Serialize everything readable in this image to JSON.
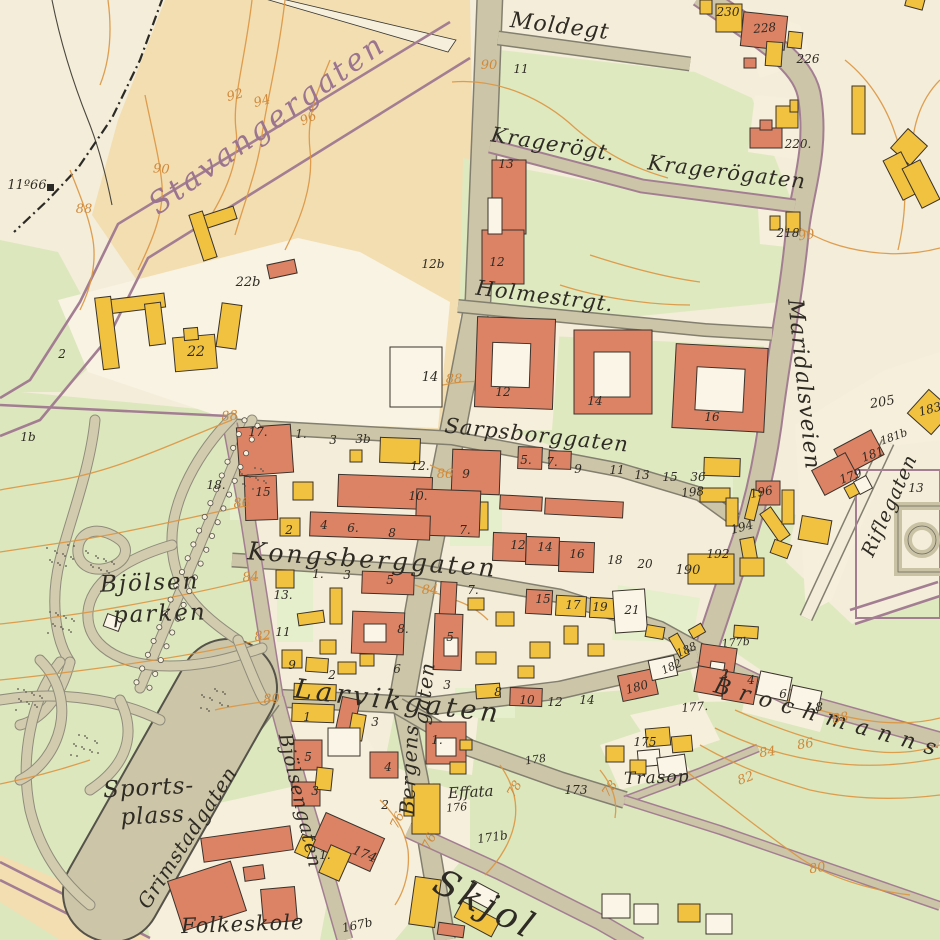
{
  "map": {
    "type": "historical-city-district-map",
    "district": "Bjölsen",
    "palette": {
      "background": "#f4edd9",
      "field_tan": "#f3deb2",
      "green": "#dfe9c0",
      "park_green": "#dce7bd",
      "road": "#ccc5a7",
      "building_red": "#dc8265",
      "building_yellow": "#f1c23f",
      "purple_line": "#a37e93",
      "contour_orange": "#db9540",
      "label_black": "#2e2b24",
      "script_purple": "#9b7490"
    },
    "street_labels": [
      {
        "t": "Stavangergaten",
        "x": 273,
        "y": 132,
        "r": -36,
        "s": 30,
        "ls": 3,
        "c": "purple"
      },
      {
        "t": "Moldegt",
        "x": 559,
        "y": 33,
        "r": 7,
        "s": 22,
        "ls": 1
      },
      {
        "t": "Kragerögt.",
        "x": 552,
        "y": 151,
        "r": 9,
        "s": 21,
        "ls": 1
      },
      {
        "t": "Kragerögaten",
        "x": 726,
        "y": 179,
        "r": 7,
        "s": 21,
        "ls": 1
      },
      {
        "t": "Holmestrgt.",
        "x": 544,
        "y": 303,
        "r": 7,
        "s": 21,
        "ls": 1
      },
      {
        "t": "Sarpsborggaten",
        "x": 536,
        "y": 442,
        "r": 6,
        "s": 21,
        "ls": 1
      },
      {
        "t": "Maridalsveien",
        "x": 797,
        "y": 385,
        "r": 84,
        "s": 22,
        "ls": 1
      },
      {
        "t": "Kongsberggaten",
        "x": 372,
        "y": 568,
        "r": 4,
        "s": 25,
        "ls": 3
      },
      {
        "t": "Larvikgaten",
        "x": 397,
        "y": 710,
        "r": 7,
        "s": 27,
        "ls": 4
      },
      {
        "t": "Bergens",
        "x": 416,
        "y": 770,
        "r": -87,
        "s": 20,
        "ls": 1
      },
      {
        "t": "gaten",
        "x": 431,
        "y": 694,
        "r": -83,
        "s": 20,
        "ls": 1
      },
      {
        "t": "Bjölsengaten",
        "x": 294,
        "y": 802,
        "r": 77,
        "s": 19,
        "ls": 1
      },
      {
        "t": "Grimstadgaten",
        "x": 193,
        "y": 841,
        "r": -57,
        "s": 20,
        "ls": 1
      },
      {
        "t": "Riflegaten",
        "x": 895,
        "y": 508,
        "r": -66,
        "s": 19,
        "ls": 1
      },
      {
        "t": "Brochmanns",
        "x": 828,
        "y": 725,
        "r": 16,
        "s": 22,
        "ls": 10
      },
      {
        "t": "Skjol",
        "x": 480,
        "y": 915,
        "r": 27,
        "s": 36,
        "ls": 4
      }
    ],
    "place_labels": [
      {
        "t": "Bjölsen",
        "x": 150,
        "y": 590,
        "r": -2,
        "s": 23,
        "ls": 2
      },
      {
        "t": "parken",
        "x": 160,
        "y": 621,
        "r": -2,
        "s": 23,
        "ls": 2
      },
      {
        "t": "Sports-",
        "x": 149,
        "y": 795,
        "r": -3,
        "s": 23,
        "ls": 1
      },
      {
        "t": "plass",
        "x": 153,
        "y": 823,
        "r": -3,
        "s": 23,
        "ls": 1
      },
      {
        "t": "Folkeskole",
        "x": 243,
        "y": 931,
        "r": -2,
        "s": 21,
        "ls": 1
      },
      {
        "t": "Trasop",
        "x": 657,
        "y": 783,
        "r": -2,
        "s": 17,
        "ls": 1
      },
      {
        "t": "Effata",
        "x": 471,
        "y": 797,
        "r": -3,
        "s": 15,
        "ls": 0
      }
    ],
    "contour_labels": [
      {
        "t": "92",
        "x": 236,
        "y": 99,
        "r": -15
      },
      {
        "t": "94",
        "x": 263,
        "y": 105,
        "r": -15
      },
      {
        "t": "96",
        "x": 310,
        "y": 122,
        "r": -25
      },
      {
        "t": "90",
        "x": 161,
        "y": 173,
        "r": 5
      },
      {
        "t": "88",
        "x": 84,
        "y": 213,
        "r": 0
      },
      {
        "t": "90",
        "x": 489,
        "y": 69,
        "r": 0
      },
      {
        "t": "90",
        "x": 807,
        "y": 239,
        "r": -10
      },
      {
        "t": "88",
        "x": 454,
        "y": 383,
        "r": 0
      },
      {
        "t": "88",
        "x": 230,
        "y": 420,
        "r": -5
      },
      {
        "t": "86",
        "x": 242,
        "y": 507,
        "r": -5
      },
      {
        "t": "86",
        "x": 445,
        "y": 478,
        "r": 0
      },
      {
        "t": "84",
        "x": 251,
        "y": 581,
        "r": -5
      },
      {
        "t": "84",
        "x": 430,
        "y": 594,
        "r": 0
      },
      {
        "t": "82",
        "x": 263,
        "y": 640,
        "r": -5
      },
      {
        "t": "80",
        "x": 272,
        "y": 703,
        "r": -5
      },
      {
        "t": "76",
        "x": 401,
        "y": 822,
        "r": -65
      },
      {
        "t": "76",
        "x": 433,
        "y": 843,
        "r": -65
      },
      {
        "t": "78",
        "x": 518,
        "y": 791,
        "r": -60
      },
      {
        "t": "78",
        "x": 613,
        "y": 791,
        "r": -55
      },
      {
        "t": "88",
        "x": 841,
        "y": 722,
        "r": -10
      },
      {
        "t": "86",
        "x": 806,
        "y": 748,
        "r": -10
      },
      {
        "t": "84",
        "x": 768,
        "y": 756,
        "r": -8
      },
      {
        "t": "82",
        "x": 747,
        "y": 782,
        "r": -20
      },
      {
        "t": "80",
        "x": 818,
        "y": 872,
        "r": -10
      }
    ],
    "parcel_labels": [
      {
        "t": "11º66",
        "x": 27,
        "y": 189,
        "s": 13
      },
      {
        "t": "2",
        "x": 62,
        "y": 358
      },
      {
        "t": "22b",
        "x": 248,
        "y": 286,
        "s": 13
      },
      {
        "t": "22",
        "x": 196,
        "y": 356,
        "s": 14
      },
      {
        "t": "12b",
        "x": 433,
        "y": 268
      },
      {
        "t": "14",
        "x": 430,
        "y": 381,
        "s": 13
      },
      {
        "t": "1b",
        "x": 28,
        "y": 441
      },
      {
        "t": "18.",
        "x": 216,
        "y": 489
      },
      {
        "t": "13.",
        "x": 283,
        "y": 599
      },
      {
        "t": "11",
        "x": 521,
        "y": 73
      },
      {
        "t": "13",
        "x": 506,
        "y": 168
      },
      {
        "t": "12",
        "x": 497,
        "y": 266
      },
      {
        "t": "12",
        "x": 503,
        "y": 396
      },
      {
        "t": "14",
        "x": 595,
        "y": 405
      },
      {
        "t": "16",
        "x": 712,
        "y": 421
      },
      {
        "t": "230",
        "x": 728,
        "y": 16
      },
      {
        "t": "228",
        "x": 765,
        "y": 32,
        "r": -5
      },
      {
        "t": "226",
        "x": 808,
        "y": 63
      },
      {
        "t": "220.",
        "x": 798,
        "y": 148
      },
      {
        "t": "218",
        "x": 788,
        "y": 237
      },
      {
        "t": "205",
        "x": 883,
        "y": 406,
        "r": -10,
        "s": 13
      },
      {
        "t": "181b",
        "x": 895,
        "y": 440,
        "r": -20,
        "s": 11
      },
      {
        "t": "181",
        "x": 874,
        "y": 458,
        "r": -20
      },
      {
        "t": "179",
        "x": 852,
        "y": 480,
        "r": -20
      },
      {
        "t": "13",
        "x": 916,
        "y": 492
      },
      {
        "t": "183",
        "x": 931,
        "y": 413,
        "r": -15
      },
      {
        "t": "17.",
        "x": 258,
        "y": 436
      },
      {
        "t": "1.",
        "x": 301,
        "y": 438
      },
      {
        "t": "3",
        "x": 333,
        "y": 444
      },
      {
        "t": "3b",
        "x": 363,
        "y": 443
      },
      {
        "t": "12.",
        "x": 420,
        "y": 470
      },
      {
        "t": "15",
        "x": 263,
        "y": 496
      },
      {
        "t": "10.",
        "x": 418,
        "y": 500
      },
      {
        "t": "2",
        "x": 289,
        "y": 534
      },
      {
        "t": "4",
        "x": 324,
        "y": 529
      },
      {
        "t": "6.",
        "x": 353,
        "y": 532
      },
      {
        "t": "8",
        "x": 392,
        "y": 537
      },
      {
        "t": "9",
        "x": 466,
        "y": 478
      },
      {
        "t": "5.",
        "x": 526,
        "y": 464
      },
      {
        "t": "7.",
        "x": 552,
        "y": 466
      },
      {
        "t": "9",
        "x": 578,
        "y": 473
      },
      {
        "t": "11",
        "x": 617,
        "y": 474
      },
      {
        "t": "13",
        "x": 642,
        "y": 479
      },
      {
        "t": "15",
        "x": 670,
        "y": 481
      },
      {
        "t": "36",
        "x": 698,
        "y": 481
      },
      {
        "t": "198",
        "x": 693,
        "y": 496,
        "r": -5
      },
      {
        "t": "196",
        "x": 762,
        "y": 496,
        "r": -10
      },
      {
        "t": "194",
        "x": 743,
        "y": 531,
        "r": -15
      },
      {
        "t": "192",
        "x": 718,
        "y": 558
      },
      {
        "t": "190",
        "x": 688,
        "y": 574,
        "s": 13
      },
      {
        "t": "12",
        "x": 518,
        "y": 549
      },
      {
        "t": "14",
        "x": 545,
        "y": 551
      },
      {
        "t": "16",
        "x": 577,
        "y": 558
      },
      {
        "t": "18",
        "x": 615,
        "y": 564
      },
      {
        "t": "20",
        "x": 645,
        "y": 568
      },
      {
        "t": "7.",
        "x": 465,
        "y": 534
      },
      {
        "t": "1.",
        "x": 318,
        "y": 578
      },
      {
        "t": "3",
        "x": 347,
        "y": 579
      },
      {
        "t": "5",
        "x": 390,
        "y": 584
      },
      {
        "t": "11",
        "x": 283,
        "y": 636
      },
      {
        "t": "8.",
        "x": 403,
        "y": 633
      },
      {
        "t": "9",
        "x": 292,
        "y": 669
      },
      {
        "t": "6",
        "x": 397,
        "y": 673
      },
      {
        "t": "2",
        "x": 332,
        "y": 679
      },
      {
        "t": "7.",
        "x": 473,
        "y": 594
      },
      {
        "t": "5",
        "x": 450,
        "y": 641
      },
      {
        "t": "3",
        "x": 447,
        "y": 689
      },
      {
        "t": "15",
        "x": 543,
        "y": 603
      },
      {
        "t": "17",
        "x": 573,
        "y": 609
      },
      {
        "t": "19",
        "x": 600,
        "y": 611
      },
      {
        "t": "21",
        "x": 632,
        "y": 614
      },
      {
        "t": "8",
        "x": 498,
        "y": 696
      },
      {
        "t": "10",
        "x": 527,
        "y": 704
      },
      {
        "t": "12",
        "x": 555,
        "y": 706
      },
      {
        "t": "14",
        "x": 587,
        "y": 704
      },
      {
        "t": "1",
        "x": 307,
        "y": 721
      },
      {
        "t": "3",
        "x": 375,
        "y": 726
      },
      {
        "t": "5",
        "x": 308,
        "y": 761
      },
      {
        "t": "4",
        "x": 388,
        "y": 771
      },
      {
        "t": "3",
        "x": 315,
        "y": 795
      },
      {
        "t": "1.",
        "x": 437,
        "y": 744
      },
      {
        "t": "2",
        "x": 385,
        "y": 809
      },
      {
        "t": "1.",
        "x": 325,
        "y": 859
      },
      {
        "t": "174",
        "x": 363,
        "y": 858,
        "r": 22,
        "s": 13
      },
      {
        "t": "167b",
        "x": 358,
        "y": 929,
        "r": -12
      },
      {
        "t": "171b",
        "x": 493,
        "y": 841,
        "r": -8
      },
      {
        "t": "173",
        "x": 576,
        "y": 794
      },
      {
        "t": "175",
        "x": 645,
        "y": 746
      },
      {
        "t": "176",
        "x": 457,
        "y": 811,
        "r": -5,
        "s": 11
      },
      {
        "t": "178",
        "x": 536,
        "y": 763,
        "r": -8,
        "s": 11
      },
      {
        "t": "177.",
        "x": 695,
        "y": 711,
        "r": -5
      },
      {
        "t": "177b",
        "x": 736,
        "y": 646,
        "r": -5,
        "s": 11
      },
      {
        "t": "180",
        "x": 638,
        "y": 691,
        "r": -15
      },
      {
        "t": "182",
        "x": 673,
        "y": 670,
        "r": -25,
        "s": 11
      },
      {
        "t": "188",
        "x": 688,
        "y": 653,
        "r": -25,
        "s": 11
      },
      {
        "t": "2",
        "x": 725,
        "y": 678
      },
      {
        "t": "4",
        "x": 751,
        "y": 684
      },
      {
        "t": "6",
        "x": 783,
        "y": 698
      },
      {
        "t": "8",
        "x": 819,
        "y": 711
      }
    ]
  }
}
